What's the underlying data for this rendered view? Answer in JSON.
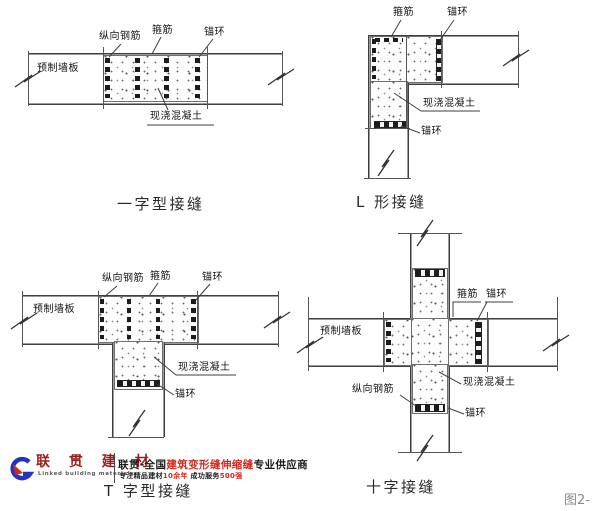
{
  "figure_label": "图2-",
  "diagrams": [
    {
      "caption": "一字型接缝",
      "labels": {
        "longitudinal_rebar": "纵向钢筋",
        "stirrup": "箍筋",
        "anchor_ring": "锚环",
        "precast_panel": "预制墙板",
        "cast_concrete": "现浇混凝土"
      }
    },
    {
      "caption": "L 形接缝",
      "labels": {
        "stirrup": "箍筋",
        "anchor_ring_top": "锚环",
        "cast_concrete": "现浇混凝土",
        "anchor_ring_bottom": "锚环"
      }
    },
    {
      "caption": "T 字型接缝",
      "labels": {
        "longitudinal_rebar": "纵向钢筋",
        "stirrup": "箍筋",
        "anchor_ring_top": "锚环",
        "precast_panel": "预制墙板",
        "cast_concrete": "现浇混凝土",
        "anchor_ring_bottom": "锚环"
      }
    },
    {
      "caption": "十字接缝",
      "labels": {
        "stirrup": "箍筋",
        "anchor_ring_right": "锚环",
        "precast_panel": "预制墙板",
        "longitudinal_rebar": "纵向钢筋",
        "cast_concrete": "现浇混凝土",
        "anchor_ring_bottom": "锚环"
      }
    }
  ],
  "watermark": {
    "brand_cn": "联 贯 建 材",
    "brand_en": "Linked building materials",
    "tagline_segments": [
      {
        "text": "联贯-全国",
        "color": "black"
      },
      {
        "text": "建筑变形缝伸缩缝",
        "color": "red"
      },
      {
        "text": "专业供应商",
        "color": "black"
      }
    ],
    "subline_segments": [
      {
        "text": "专注精品建材",
        "color": "black"
      },
      {
        "text": "10余年",
        "color": "red"
      },
      {
        "text": " 成功服务",
        "color": "black"
      },
      {
        "text": "500强",
        "color": "red"
      }
    ],
    "colors": {
      "red": "#d3281e",
      "blue": "#2433c0"
    }
  }
}
